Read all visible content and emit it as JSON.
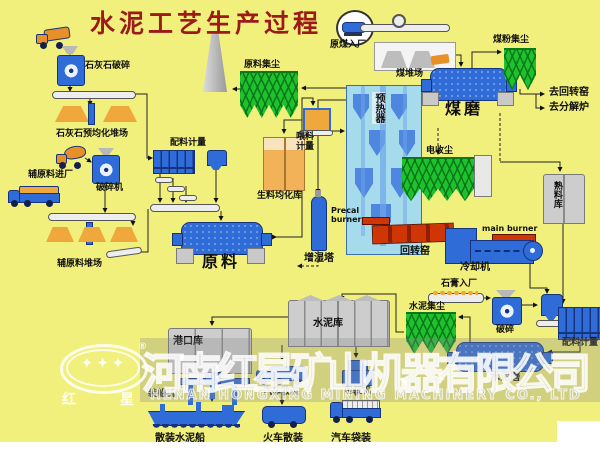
{
  "title": "水泥工艺生产过程",
  "sections": {
    "limestone": {
      "crushing": "石灰石破碎",
      "preblend_yard": "石灰石预均化堆场"
    },
    "auxiliary": {
      "entry": "辅原料进厂",
      "crusher": "破碎机",
      "yard": "辅原料堆场",
      "batching": "配料计量"
    },
    "raw": {
      "dust_collector": "原料集尘",
      "mill": "原料",
      "homogenization_silo": "生料均化库",
      "feed_metering": "喂料计量",
      "humidifier_tower": "增湿塔",
      "preheater": "预热器"
    },
    "coal": {
      "entry": "原煤入厂",
      "yard": "煤堆场",
      "dust_collector": "煤粉集尘",
      "mill": "煤磨",
      "to_rotary_kiln": "去回转窑",
      "to_calciner": "去分解炉"
    },
    "kiln": {
      "precal_burner": "Precal burner",
      "rotary_kiln": "回转窑",
      "main_burner": "main burner",
      "cooler": "冷却机",
      "esp": "电收尘",
      "clinker_silo": "熟料库"
    },
    "cement": {
      "gypsum_entry": "石膏入厂",
      "gypsum_crusher": "破碎",
      "batching": "配料计量",
      "dust_collector": "水泥集尘",
      "mill": "水泥磨",
      "silo": "水泥库"
    },
    "shipping": {
      "port_silo": "港口库",
      "ship_loader": "装船机",
      "bulk_ship": "散装水泥船",
      "truck_bulk": "汽车散装",
      "train_bulk": "火车散装",
      "packer": "包装机",
      "truck_bag": "汽车袋装"
    }
  },
  "watermark": {
    "company_cn": "河南红星矿山机器有限公司",
    "company_en": "HENAN HONGXING MINING MACHINERY CO., LTD",
    "logo_char_left": "红",
    "logo_char_right": "星",
    "logo_stars": "✦✦✦",
    "registered": "®"
  },
  "colors": {
    "background": "#F1F07C",
    "equipment_blue": "#2F6CD8",
    "filter_green": "#1EC22E",
    "kiln_red": "#CF3505",
    "material_orange": "#F0A83C",
    "silo_gray": "#CDCDCD",
    "preheater_cyan": "#A6DBEC",
    "title_red": "#9C1A1A"
  }
}
